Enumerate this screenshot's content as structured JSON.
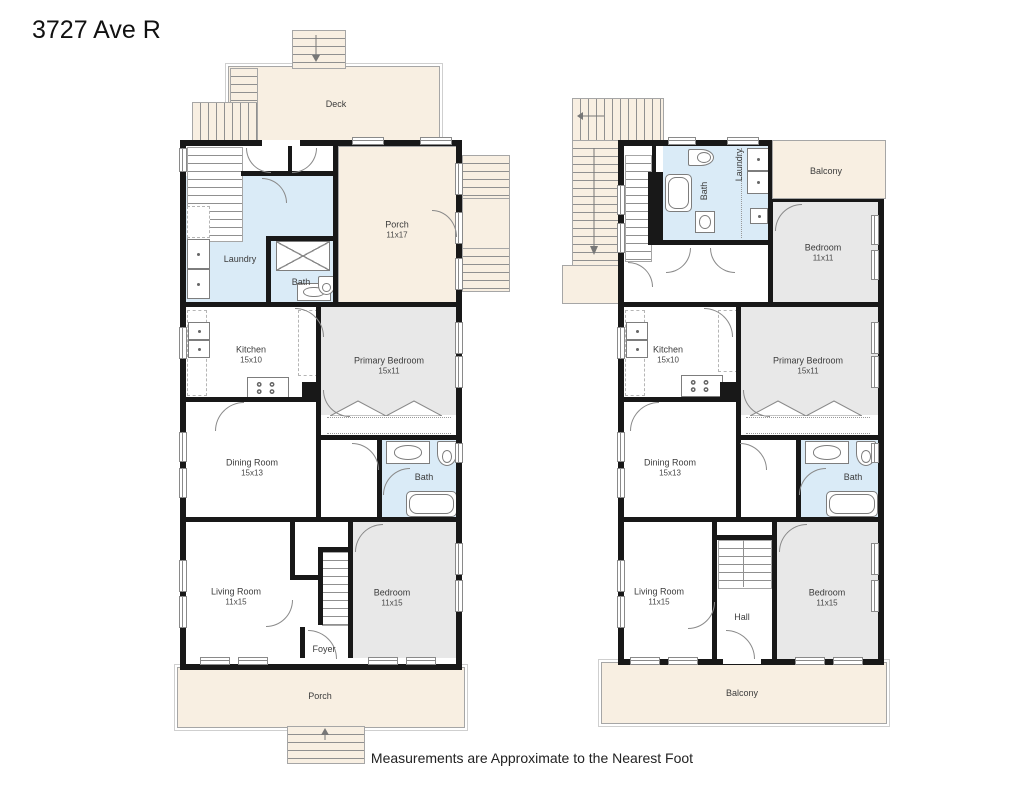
{
  "title": "3727 Ave R",
  "footer_note": "Measurements are Approximate to the Nearest Foot",
  "colors": {
    "outdoor_fill": "#f8efe2",
    "wet_room_fill": "#daebf7",
    "bedroom_fill": "#e8e8e8",
    "wall": "#181818"
  },
  "floor1": {
    "deck": {
      "label": "Deck"
    },
    "porch_upper": {
      "label": "Porch",
      "dims": "11x17"
    },
    "laundry": {
      "label": "Laundry"
    },
    "bath_upper": {
      "label": "Bath"
    },
    "kitchen": {
      "label": "Kitchen",
      "dims": "15x10"
    },
    "primary_bedroom": {
      "label": "Primary Bedroom",
      "dims": "15x11"
    },
    "dining_room": {
      "label": "Dining Room",
      "dims": "15x13"
    },
    "bath_main": {
      "label": "Bath"
    },
    "living_room": {
      "label": "Living Room",
      "dims": "11x15"
    },
    "bedroom": {
      "label": "Bedroom",
      "dims": "11x15"
    },
    "foyer": {
      "label": "Foyer"
    },
    "porch_front": {
      "label": "Porch"
    }
  },
  "floor2": {
    "balcony_rear": {
      "label": "Balcony"
    },
    "bath_rear": {
      "label": "Bath"
    },
    "laundry": {
      "label": "Laundry"
    },
    "bedroom_rear": {
      "label": "Bedroom",
      "dims": "11x11"
    },
    "kitchen": {
      "label": "Kitchen",
      "dims": "15x10"
    },
    "primary_bedroom": {
      "label": "Primary Bedroom",
      "dims": "15x11"
    },
    "dining_room": {
      "label": "Dining Room",
      "dims": "15x13"
    },
    "bath_main": {
      "label": "Bath"
    },
    "living_room": {
      "label": "Living Room",
      "dims": "11x15"
    },
    "hall": {
      "label": "Hall"
    },
    "bedroom_front": {
      "label": "Bedroom",
      "dims": "11x15"
    },
    "balcony_front": {
      "label": "Balcony"
    }
  }
}
